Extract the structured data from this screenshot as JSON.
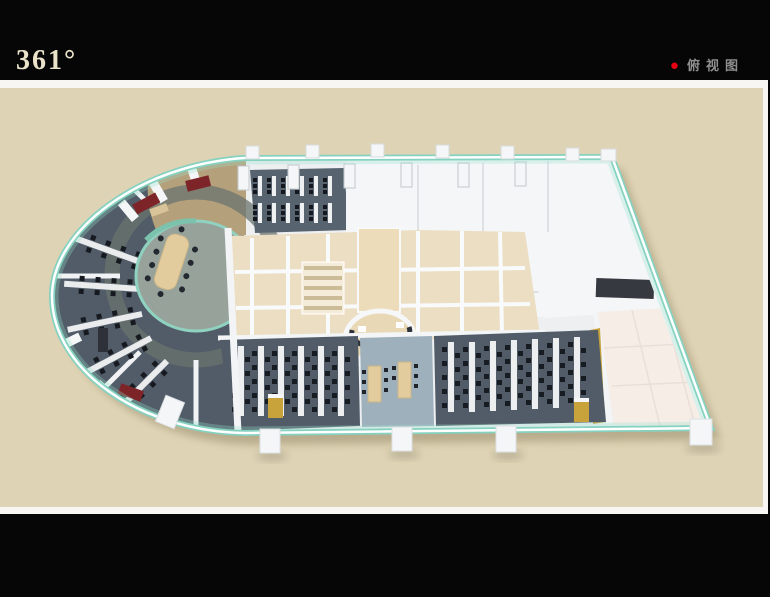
{
  "header": {
    "logo_text": "361°",
    "view_indicator": {
      "bullet": "●",
      "label": "俯视图"
    }
  },
  "palette": {
    "frame-black": "#060606",
    "band-white": "#f7f6f2",
    "canvas-beige": "#ded3b4",
    "logo-cream": "#eae3c9",
    "label-gray": "#8f8f8f",
    "dot-red": "#e60012",
    "glass-teal": "#85d2c0",
    "wall-white": "#f4f6f7",
    "floor-light": "#edeff1",
    "carpet-dark": "#515c68",
    "carpet-blue": "#9fb0bd",
    "floor-tan": "#ecdec2",
    "table-tan": "#e2cc9e",
    "accent-gold": "#c8a33c",
    "sofa-red": "#7c2428",
    "chair-dark": "#1b2026",
    "room-pink": "#f7ede7"
  }
}
